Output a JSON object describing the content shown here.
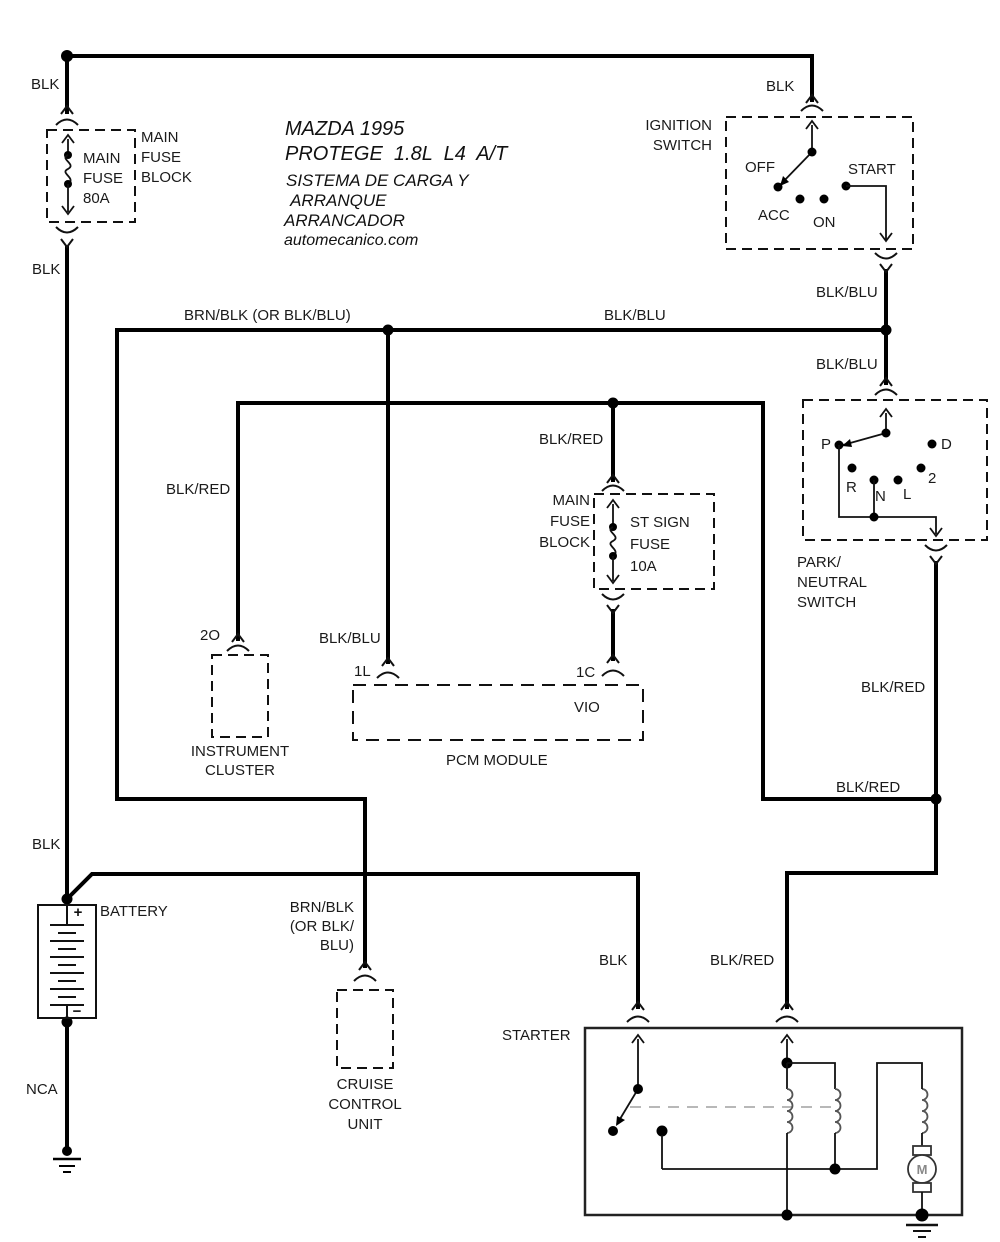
{
  "title": {
    "line1": "MAZDA 1995",
    "line2": "PROTEGE  1.8L  L4  A/T",
    "line3": "SISTEMA DE CARGA Y",
    "line4": " ARRANQUE",
    "line5": "ARRANCADOR",
    "line6": "automecanico.com"
  },
  "wires": {
    "blk_top": "BLK",
    "blk_upper": "BLK",
    "blk_battery": "BLK",
    "blk_starter": "BLK",
    "blk_ignition": "BLK",
    "blkblu_main": "BLK/BLU",
    "blkblu_exit": "BLK/BLU",
    "blkblu_pnp": "BLK/BLU",
    "blkblu_pcm": "BLK/BLU",
    "brnblk_long": "BRN/BLK (OR BLK/BLU)",
    "brnblk_l1": "BRN/BLK",
    "brnblk_l2": "(OR BLK/",
    "brnblk_l3": "BLU)",
    "blkred_cluster": "BLK/RED",
    "blkred_fuse": "BLK/RED",
    "blkred_pnp": "BLK/RED",
    "blkred_junction": "BLK/RED",
    "blkred_starter": "BLK/RED",
    "vio": "VIO",
    "nca": "NCA"
  },
  "main_fuse": {
    "block_l1": "MAIN",
    "block_l2": "FUSE",
    "block_l3": "BLOCK",
    "fuse_l1": "MAIN",
    "fuse_l2": "FUSE",
    "fuse_l3": "80A"
  },
  "st_sign_fuse": {
    "block_l1": "MAIN",
    "block_l2": "FUSE",
    "block_l3": "BLOCK",
    "fuse_l1": "ST SIGN",
    "fuse_l2": "FUSE",
    "fuse_l3": "10A"
  },
  "ignition_switch": {
    "name_l1": "IGNITION",
    "name_l2": "SWITCH",
    "off": "OFF",
    "acc": "ACC",
    "on": "ON",
    "start": "START"
  },
  "park_neutral_switch": {
    "name_l1": "PARK/",
    "name_l2": "NEUTRAL",
    "name_l3": "SWITCH",
    "p": "P",
    "r": "R",
    "n": "N",
    "l": "L",
    "d": "D",
    "two": "2"
  },
  "instrument_cluster": {
    "name_l1": "INSTRUMENT",
    "name_l2": "CLUSTER",
    "terminal": "2O"
  },
  "pcm": {
    "name": "PCM MODULE",
    "terminal_left": "1L",
    "terminal_right": "1C"
  },
  "battery": {
    "name": "BATTERY",
    "plus": "+",
    "minus": "−"
  },
  "cruise": {
    "name_l1": "CRUISE",
    "name_l2": "CONTROL",
    "name_l3": "UNIT"
  },
  "starter": {
    "name": "STARTER",
    "motor": "M"
  },
  "colors": {
    "wire": "#000000",
    "box": "#111111",
    "linkage": "#b8b8b8",
    "coil": "#555555",
    "background": "#ffffff"
  }
}
